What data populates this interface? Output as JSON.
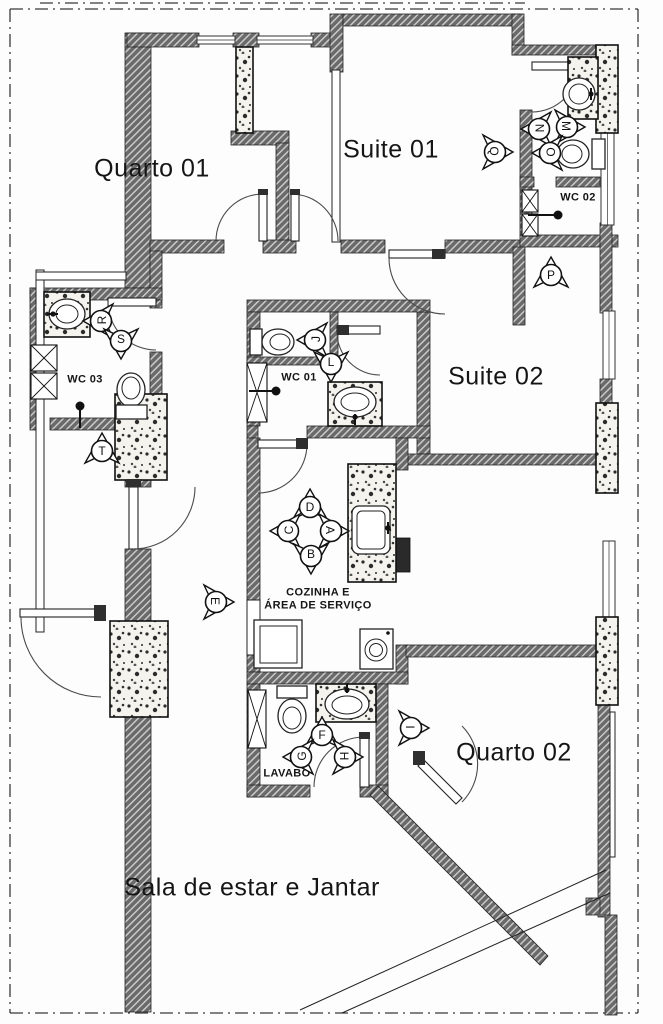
{
  "plan_name": "apartment-floor-plan",
  "colors": {
    "wall_fill": "#6a6a6a",
    "wall_hatch_line": "#cfcfcf",
    "outline": "#1f1f1f",
    "column_bg": "#f5f3ee",
    "column_dot": "#2b2b2b",
    "door_arc": "#4a4a4a",
    "dash_line": "#3a3a3a",
    "text": "#151515",
    "service_block": "#2a2a2a"
  },
  "rooms": [
    {
      "id": "quarto-01",
      "lines": [
        "Quarto 01"
      ],
      "x": 152,
      "y": 169,
      "size": "lg"
    },
    {
      "id": "suite-01",
      "lines": [
        "Suite 01"
      ],
      "x": 391,
      "y": 150,
      "size": "lg"
    },
    {
      "id": "wc-02",
      "lines": [
        "WC 02"
      ],
      "x": 578,
      "y": 198,
      "size": "sm"
    },
    {
      "id": "suite-02",
      "lines": [
        "Suite 02"
      ],
      "x": 496,
      "y": 377,
      "size": "lg"
    },
    {
      "id": "wc-03",
      "lines": [
        "WC 03"
      ],
      "x": 85,
      "y": 380,
      "size": "sm"
    },
    {
      "id": "wc-01",
      "lines": [
        "WC 01"
      ],
      "x": 299,
      "y": 378,
      "size": "sm"
    },
    {
      "id": "cozinha",
      "lines": [
        "COZINHA E",
        "ÁREA DE SERVIÇO"
      ],
      "x": 318,
      "y": 599,
      "size": "sm"
    },
    {
      "id": "lavabo",
      "lines": [
        "LAVABO"
      ],
      "x": 287,
      "y": 774,
      "size": "sm"
    },
    {
      "id": "quarto-02",
      "lines": [
        "Quarto 02"
      ],
      "x": 514,
      "y": 753,
      "size": "lg"
    },
    {
      "id": "sala",
      "lines": [
        "Sala de estar e Jantar"
      ],
      "x": 252,
      "y": 888,
      "size": "lg"
    }
  ],
  "markers": [
    {
      "letter": "Q",
      "x": 494,
      "y": 152,
      "dir": "right"
    },
    {
      "letter": "N",
      "x": 540,
      "y": 129,
      "dir": "left"
    },
    {
      "letter": "M",
      "x": 566,
      "y": 127,
      "dir": "right"
    },
    {
      "letter": "O",
      "x": 551,
      "y": 153,
      "dir": "left"
    },
    {
      "letter": "P",
      "x": 551,
      "y": 276,
      "dir": "up"
    },
    {
      "letter": "R",
      "x": 102,
      "y": 321,
      "dir": "left"
    },
    {
      "letter": "S",
      "x": 121,
      "y": 340,
      "dir": "down"
    },
    {
      "letter": "T",
      "x": 102,
      "y": 452,
      "dir": "up"
    },
    {
      "letter": "J",
      "x": 316,
      "y": 340,
      "dir": "left"
    },
    {
      "letter": "L",
      "x": 331,
      "y": 363,
      "dir": "down"
    },
    {
      "letter": "D",
      "x": 310,
      "y": 508,
      "dir": "up"
    },
    {
      "letter": "C",
      "x": 289,
      "y": 531,
      "dir": "left"
    },
    {
      "letter": "A",
      "x": 330,
      "y": 531,
      "dir": "right"
    },
    {
      "letter": "B",
      "x": 311,
      "y": 555,
      "dir": "down"
    },
    {
      "letter": "E",
      "x": 215,
      "y": 602,
      "dir": "right"
    },
    {
      "letter": "F",
      "x": 322,
      "y": 736,
      "dir": "up"
    },
    {
      "letter": "G",
      "x": 302,
      "y": 757,
      "dir": "left"
    },
    {
      "letter": "H",
      "x": 344,
      "y": 757,
      "dir": "right"
    },
    {
      "letter": "I",
      "x": 410,
      "y": 728,
      "dir": "right"
    }
  ]
}
